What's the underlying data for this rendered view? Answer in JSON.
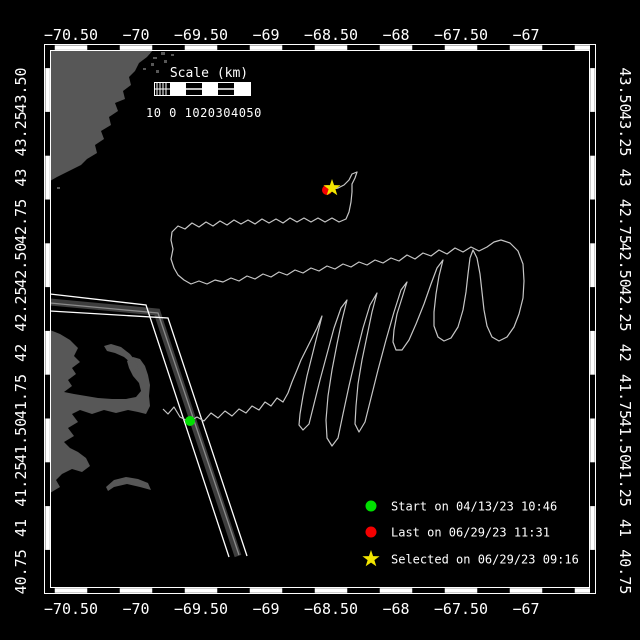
{
  "window": {
    "background": "#000000"
  },
  "map": {
    "frame_color": "#ffffff",
    "land_color": "#575757",
    "water_color": "#000000",
    "track_color": "#c6c6c6",
    "lane_band_color": "#3e3e3e",
    "lane_center_color": "#8a8a8a",
    "lane_edge_color": "#ffffff"
  },
  "axes": {
    "top": [
      "−70.50",
      "−70",
      "−69.50",
      "−69",
      "−68.50",
      "−68",
      "−67.50",
      "−67"
    ],
    "bottom": [
      "−70.50",
      "−70",
      "−69.50",
      "−69",
      "−68.50",
      "−68",
      "−67.50",
      "−67"
    ],
    "left": [
      "43.50",
      "43.25",
      "43",
      "42.75",
      "42.50",
      "42.25",
      "42",
      "41.75",
      "41.50",
      "41.25",
      "41",
      "40.75"
    ],
    "right": [
      "43.50",
      "43.25",
      "43",
      "42.75",
      "42.50",
      "42.25",
      "42",
      "41.75",
      "41.50",
      "41.25",
      "41",
      "40.75"
    ]
  },
  "scalebar": {
    "title": "Scale (km)",
    "labels": "10 0 1020304050"
  },
  "legend": {
    "items": [
      {
        "marker": "circle",
        "color": "#00df00",
        "label": "Start on 04/13/23 10:46"
      },
      {
        "marker": "circle",
        "color": "#f40000",
        "label": "Last on 06/29/23 11:31"
      },
      {
        "marker": "star",
        "color": "#f2e500",
        "label": "Selected on 06/29/23 09:16"
      }
    ]
  },
  "markers": {
    "start": {
      "x": 190,
      "y": 421,
      "shape": "circle",
      "color": "#00df00"
    },
    "last": {
      "x": 327,
      "y": 190,
      "shape": "circle",
      "color": "#f40000"
    },
    "selected": {
      "x": 332,
      "y": 188,
      "shape": "star",
      "color": "#f2e500"
    }
  },
  "track_points": [
    [
      163,
      409
    ],
    [
      168,
      414
    ],
    [
      174,
      407
    ],
    [
      180,
      417
    ],
    [
      186,
      420
    ],
    [
      190,
      421
    ],
    [
      197,
      417
    ],
    [
      204,
      421
    ],
    [
      211,
      413
    ],
    [
      218,
      418
    ],
    [
      225,
      411
    ],
    [
      232,
      416
    ],
    [
      239,
      409
    ],
    [
      246,
      413
    ],
    [
      252,
      406
    ],
    [
      259,
      410
    ],
    [
      265,
      402
    ],
    [
      271,
      406
    ],
    [
      277,
      398
    ],
    [
      283,
      402
    ],
    [
      288,
      393
    ],
    [
      292,
      382
    ],
    [
      297,
      370
    ],
    [
      301,
      360
    ],
    [
      306,
      350
    ],
    [
      311,
      340
    ],
    [
      317,
      328
    ],
    [
      322,
      316
    ],
    [
      317,
      336
    ],
    [
      312,
      356
    ],
    [
      307,
      376
    ],
    [
      303,
      396
    ],
    [
      300,
      414
    ],
    [
      299,
      425
    ],
    [
      303,
      430
    ],
    [
      309,
      424
    ],
    [
      314,
      404
    ],
    [
      320,
      380
    ],
    [
      327,
      354
    ],
    [
      334,
      328
    ],
    [
      341,
      308
    ],
    [
      347,
      300
    ],
    [
      342,
      320
    ],
    [
      337,
      344
    ],
    [
      332,
      370
    ],
    [
      328,
      396
    ],
    [
      326,
      420
    ],
    [
      327,
      438
    ],
    [
      332,
      446
    ],
    [
      338,
      438
    ],
    [
      343,
      414
    ],
    [
      349,
      386
    ],
    [
      356,
      356
    ],
    [
      363,
      328
    ],
    [
      370,
      305
    ],
    [
      377,
      293
    ],
    [
      372,
      312
    ],
    [
      367,
      336
    ],
    [
      362,
      360
    ],
    [
      358,
      384
    ],
    [
      356,
      406
    ],
    [
      355,
      424
    ],
    [
      359,
      432
    ],
    [
      365,
      422
    ],
    [
      371,
      398
    ],
    [
      378,
      370
    ],
    [
      386,
      340
    ],
    [
      394,
      312
    ],
    [
      401,
      290
    ],
    [
      407,
      282
    ],
    [
      402,
      298
    ],
    [
      397,
      314
    ],
    [
      394,
      330
    ],
    [
      393,
      342
    ],
    [
      396,
      350
    ],
    [
      402,
      350
    ],
    [
      409,
      340
    ],
    [
      416,
      324
    ],
    [
      424,
      304
    ],
    [
      431,
      284
    ],
    [
      437,
      268
    ],
    [
      443,
      260
    ],
    [
      439,
      276
    ],
    [
      436,
      294
    ],
    [
      434,
      312
    ],
    [
      434,
      326
    ],
    [
      438,
      337
    ],
    [
      444,
      341
    ],
    [
      451,
      338
    ],
    [
      458,
      327
    ],
    [
      463,
      310
    ],
    [
      466,
      292
    ],
    [
      468,
      274
    ],
    [
      470,
      258
    ],
    [
      473,
      250
    ],
    [
      477,
      258
    ],
    [
      480,
      274
    ],
    [
      482,
      292
    ],
    [
      484,
      310
    ],
    [
      487,
      326
    ],
    [
      492,
      337
    ],
    [
      499,
      341
    ],
    [
      507,
      337
    ],
    [
      514,
      327
    ],
    [
      519,
      314
    ],
    [
      523,
      298
    ],
    [
      524,
      281
    ],
    [
      523,
      264
    ],
    [
      518,
      251
    ],
    [
      510,
      243
    ],
    [
      501,
      240
    ],
    [
      494,
      242
    ],
    [
      487,
      247
    ],
    [
      479,
      251
    ],
    [
      471,
      247
    ],
    [
      463,
      252
    ],
    [
      455,
      248
    ],
    [
      447,
      254
    ],
    [
      439,
      250
    ],
    [
      431,
      256
    ],
    [
      423,
      253
    ],
    [
      415,
      259
    ],
    [
      407,
      255
    ],
    [
      399,
      261
    ],
    [
      391,
      258
    ],
    [
      383,
      263
    ],
    [
      375,
      260
    ],
    [
      367,
      265
    ],
    [
      359,
      262
    ],
    [
      351,
      267
    ],
    [
      343,
      264
    ],
    [
      335,
      269
    ],
    [
      327,
      266
    ],
    [
      319,
      271
    ],
    [
      311,
      268
    ],
    [
      303,
      273
    ],
    [
      295,
      270
    ],
    [
      287,
      275
    ],
    [
      279,
      272
    ],
    [
      271,
      277
    ],
    [
      263,
      274
    ],
    [
      255,
      279
    ],
    [
      247,
      276
    ],
    [
      239,
      281
    ],
    [
      231,
      278
    ],
    [
      223,
      282
    ],
    [
      215,
      280
    ],
    [
      207,
      284
    ],
    [
      199,
      281
    ],
    [
      191,
      284
    ],
    [
      184,
      280
    ],
    [
      178,
      275
    ],
    [
      174,
      268
    ],
    [
      171,
      259
    ],
    [
      173,
      249
    ],
    [
      171,
      240
    ],
    [
      172,
      232
    ],
    [
      178,
      226
    ],
    [
      185,
      229
    ],
    [
      192,
      223
    ],
    [
      199,
      227
    ],
    [
      206,
      222
    ],
    [
      213,
      226
    ],
    [
      220,
      221
    ],
    [
      227,
      225
    ],
    [
      234,
      220
    ],
    [
      241,
      224
    ],
    [
      248,
      220
    ],
    [
      255,
      224
    ],
    [
      262,
      219
    ],
    [
      269,
      223
    ],
    [
      276,
      219
    ],
    [
      283,
      223
    ],
    [
      290,
      218
    ],
    [
      297,
      222
    ],
    [
      304,
      218
    ],
    [
      311,
      222
    ],
    [
      318,
      218
    ],
    [
      325,
      222
    ],
    [
      332,
      218
    ],
    [
      339,
      222
    ],
    [
      346,
      219
    ],
    [
      349,
      212
    ],
    [
      351,
      202
    ],
    [
      352,
      192
    ],
    [
      352,
      184
    ],
    [
      355,
      178
    ],
    [
      357,
      172
    ],
    [
      352,
      174
    ],
    [
      349,
      180
    ],
    [
      344,
      185
    ],
    [
      338,
      188
    ],
    [
      333,
      189
    ]
  ],
  "land": {
    "polygons": [
      {
        "name": "northeast-coast",
        "points": [
          [
            50,
            50
          ],
          [
            153,
            50
          ],
          [
            147,
            57
          ],
          [
            139,
            63
          ],
          [
            135,
            71
          ],
          [
            129,
            77
          ],
          [
            131,
            85
          ],
          [
            123,
            91
          ],
          [
            125,
            99
          ],
          [
            115,
            103
          ],
          [
            118,
            111
          ],
          [
            109,
            117
          ],
          [
            111,
            125
          ],
          [
            101,
            131
          ],
          [
            104,
            139
          ],
          [
            95,
            145
          ],
          [
            97,
            153
          ],
          [
            87,
            159
          ],
          [
            81,
            165
          ],
          [
            73,
            169
          ],
          [
            65,
            173
          ],
          [
            57,
            177
          ],
          [
            50,
            181
          ]
        ]
      },
      {
        "name": "cape-cod-mainland",
        "points": [
          [
            50,
            330
          ],
          [
            60,
            334
          ],
          [
            70,
            340
          ],
          [
            78,
            348
          ],
          [
            74,
            356
          ],
          [
            80,
            362
          ],
          [
            72,
            368
          ],
          [
            76,
            374
          ],
          [
            68,
            380
          ],
          [
            72,
            386
          ],
          [
            64,
            392
          ],
          [
            74,
            394
          ],
          [
            86,
            396
          ],
          [
            98,
            398
          ],
          [
            112,
            399
          ],
          [
            126,
            399
          ],
          [
            136,
            397
          ],
          [
            141,
            391
          ],
          [
            139,
            383
          ],
          [
            133,
            376
          ],
          [
            129,
            368
          ],
          [
            127,
            361
          ],
          [
            133,
            357
          ],
          [
            140,
            359
          ],
          [
            145,
            366
          ],
          [
            148,
            375
          ],
          [
            150,
            385
          ],
          [
            149,
            396
          ],
          [
            150,
            406
          ],
          [
            146,
            414
          ],
          [
            138,
            412
          ],
          [
            128,
            410
          ],
          [
            116,
            413
          ],
          [
            104,
            410
          ],
          [
            92,
            414
          ],
          [
            80,
            410
          ],
          [
            72,
            414
          ],
          [
            78,
            422
          ],
          [
            68,
            428
          ],
          [
            74,
            436
          ],
          [
            64,
            442
          ],
          [
            70,
            448
          ],
          [
            78,
            452
          ],
          [
            86,
            458
          ],
          [
            90,
            466
          ],
          [
            82,
            472
          ],
          [
            72,
            469
          ],
          [
            62,
            474
          ],
          [
            56,
            480
          ],
          [
            60,
            487
          ],
          [
            50,
            493
          ]
        ]
      },
      {
        "name": "provincetown-hook",
        "points": [
          [
            137,
            363
          ],
          [
            130,
            354
          ],
          [
            121,
            347
          ],
          [
            111,
            344
          ],
          [
            104,
            346
          ],
          [
            107,
            351
          ],
          [
            115,
            353
          ],
          [
            124,
            357
          ],
          [
            131,
            363
          ],
          [
            134,
            369
          ],
          [
            139,
            371
          ]
        ]
      },
      {
        "name": "nantucket",
        "points": [
          [
            106,
            487
          ],
          [
            114,
            480
          ],
          [
            126,
            477
          ],
          [
            138,
            479
          ],
          [
            148,
            483
          ],
          [
            151,
            490
          ],
          [
            140,
            487
          ],
          [
            127,
            484
          ],
          [
            114,
            487
          ],
          [
            108,
            491
          ]
        ]
      }
    ],
    "islets": [
      [
        112,
        51,
        5,
        3
      ],
      [
        121,
        55,
        4,
        3
      ],
      [
        129,
        50,
        4,
        4
      ],
      [
        137,
        56,
        5,
        3
      ],
      [
        146,
        51,
        4,
        3
      ],
      [
        153,
        57,
        4,
        2
      ],
      [
        161,
        52,
        4,
        3
      ],
      [
        151,
        63,
        3,
        3
      ],
      [
        143,
        68,
        3,
        2
      ],
      [
        156,
        70,
        3,
        3
      ],
      [
        164,
        60,
        3,
        3
      ],
      [
        171,
        54,
        3,
        2
      ],
      [
        57,
        187,
        3,
        2
      ]
    ]
  },
  "lane": {
    "edge1": [
      [
        50,
        294
      ],
      [
        146,
        305
      ],
      [
        229,
        557
      ]
    ],
    "edge2": [
      [
        50,
        311
      ],
      [
        168,
        318
      ],
      [
        247,
        556
      ]
    ],
    "band": [
      [
        50,
        302
      ],
      [
        157,
        312
      ],
      [
        238,
        556
      ]
    ],
    "center": [
      [
        50,
        303
      ],
      [
        158,
        313
      ],
      [
        239,
        555
      ]
    ]
  }
}
